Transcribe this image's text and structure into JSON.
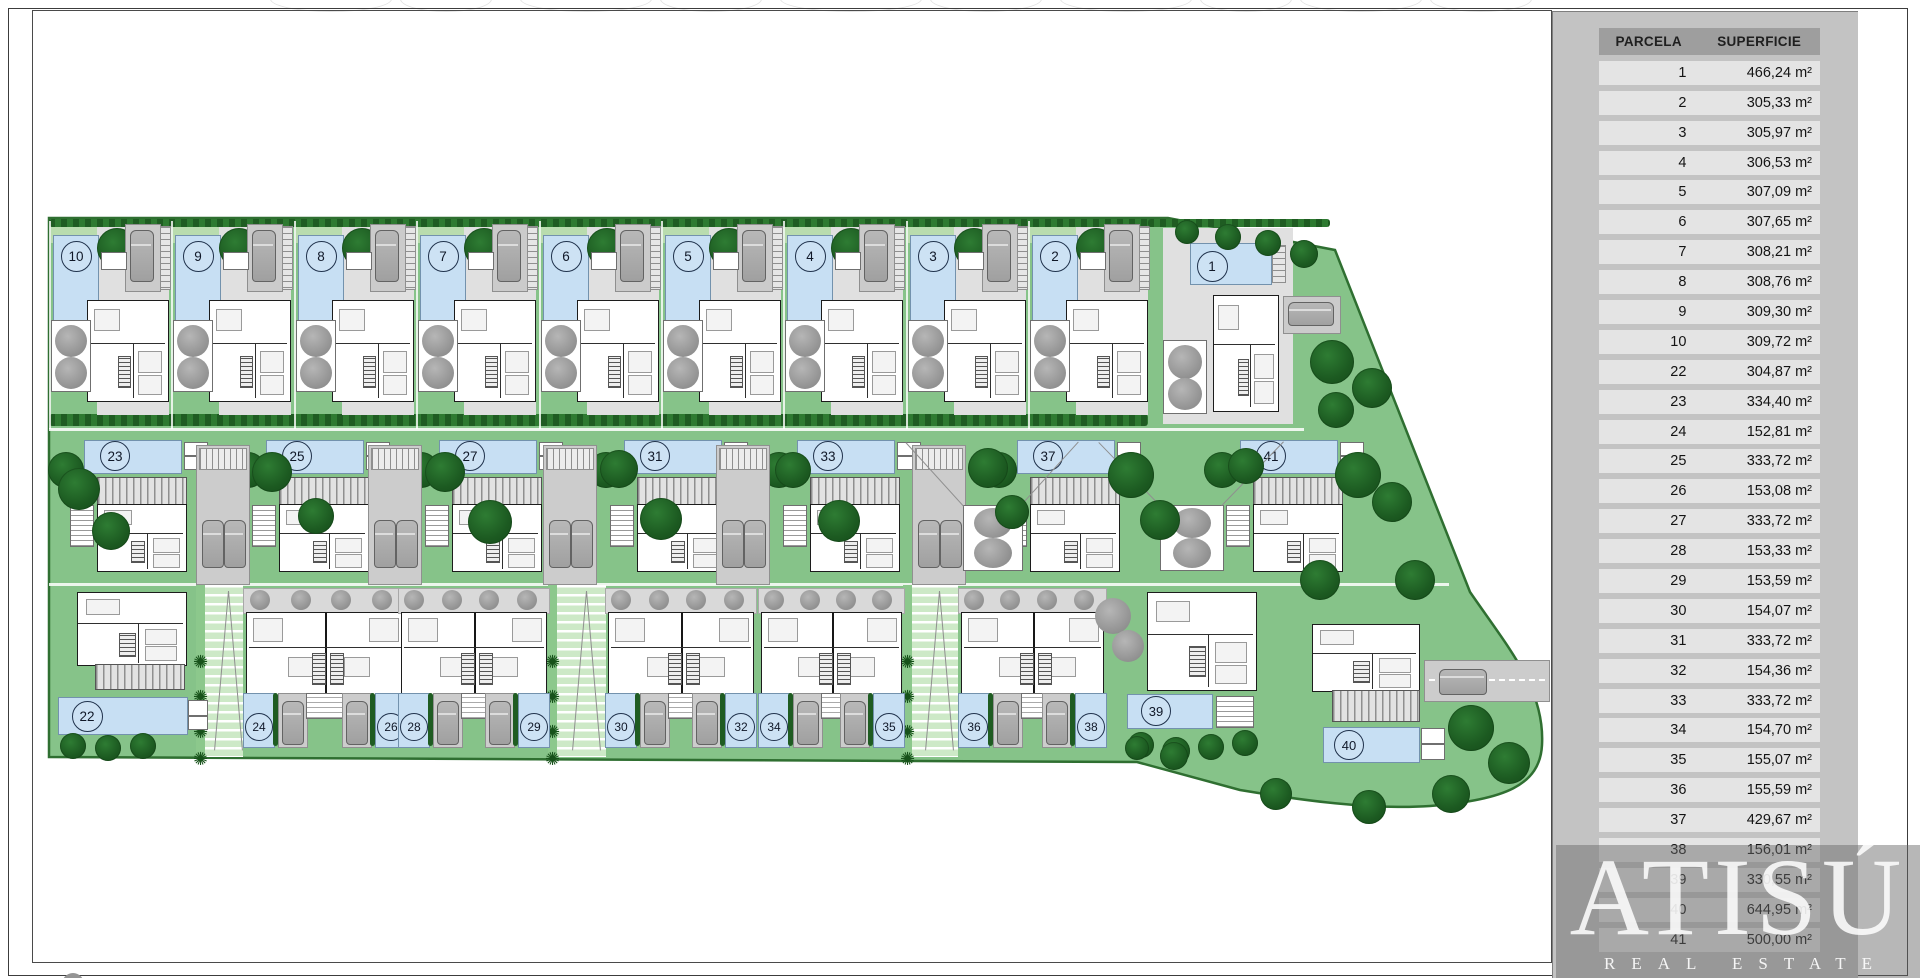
{
  "table": {
    "header": {
      "parcela": "PARCELA",
      "superficie": "SUPERFICIE"
    },
    "rows": [
      {
        "parcela": "1",
        "superficie": "466,24 m²"
      },
      {
        "parcela": "2",
        "superficie": "305,33 m²"
      },
      {
        "parcela": "3",
        "superficie": "305,97 m²"
      },
      {
        "parcela": "4",
        "superficie": "306,53 m²"
      },
      {
        "parcela": "5",
        "superficie": "307,09 m²"
      },
      {
        "parcela": "6",
        "superficie": "307,65 m²"
      },
      {
        "parcela": "7",
        "superficie": "308,21 m²"
      },
      {
        "parcela": "8",
        "superficie": "308,76 m²"
      },
      {
        "parcela": "9",
        "superficie": "309,30 m²"
      },
      {
        "parcela": "10",
        "superficie": "309,72 m²"
      },
      {
        "parcela": "22",
        "superficie": "304,87 m²"
      },
      {
        "parcela": "23",
        "superficie": "334,40 m²"
      },
      {
        "parcela": "24",
        "superficie": "152,81 m²"
      },
      {
        "parcela": "25",
        "superficie": "333,72 m²"
      },
      {
        "parcela": "26",
        "superficie": "153,08 m²"
      },
      {
        "parcela": "27",
        "superficie": "333,72 m²"
      },
      {
        "parcela": "28",
        "superficie": "153,33 m²"
      },
      {
        "parcela": "29",
        "superficie": "153,59 m²"
      },
      {
        "parcela": "30",
        "superficie": "154,07 m²"
      },
      {
        "parcela": "31",
        "superficie": "333,72 m²"
      },
      {
        "parcela": "32",
        "superficie": "154,36 m²"
      },
      {
        "parcela": "33",
        "superficie": "333,72 m²"
      },
      {
        "parcela": "34",
        "superficie": "154,70 m²"
      },
      {
        "parcela": "35",
        "superficie": "155,07 m²"
      },
      {
        "parcela": "36",
        "superficie": "155,59 m²"
      },
      {
        "parcela": "37",
        "superficie": "429,67 m²"
      },
      {
        "parcela": "38",
        "superficie": "156,01 m²"
      },
      {
        "parcela": "39",
        "superficie": "330,55 m²"
      },
      {
        "parcela": "40",
        "superficie": "644,95 m²"
      },
      {
        "parcela": "41",
        "superficie": "500,00 m²"
      }
    ]
  },
  "logo": {
    "brand": "ATISÚ",
    "tagline": "REAL ESTATE"
  },
  "plan": {
    "top_row": [
      "10",
      "9",
      "8",
      "7",
      "6",
      "5",
      "4",
      "3",
      "2"
    ],
    "plot_one": "1",
    "middle_row": [
      "23",
      "25",
      "27",
      "31",
      "33",
      "37",
      "41"
    ],
    "bottom_pairs": [
      [
        "24",
        "26"
      ],
      [
        "28",
        "29"
      ],
      [
        "30",
        "32"
      ],
      [
        "34",
        "35"
      ],
      [
        "36",
        "38"
      ]
    ],
    "corner_left": "22",
    "corner_right": [
      "39",
      "40"
    ]
  },
  "colors": {
    "site_green": "#86c389",
    "site_border": "#2f6f31",
    "pool_blue": "#c7dff3",
    "tree_dark": "#1c5a21",
    "tree_gray": "#9b9b9b",
    "paving_gray": "#e0e0e0",
    "panel_gray": "#c3c3c3",
    "header_gray": "#9e9e9e",
    "row_gray": "#e4e4e4"
  }
}
